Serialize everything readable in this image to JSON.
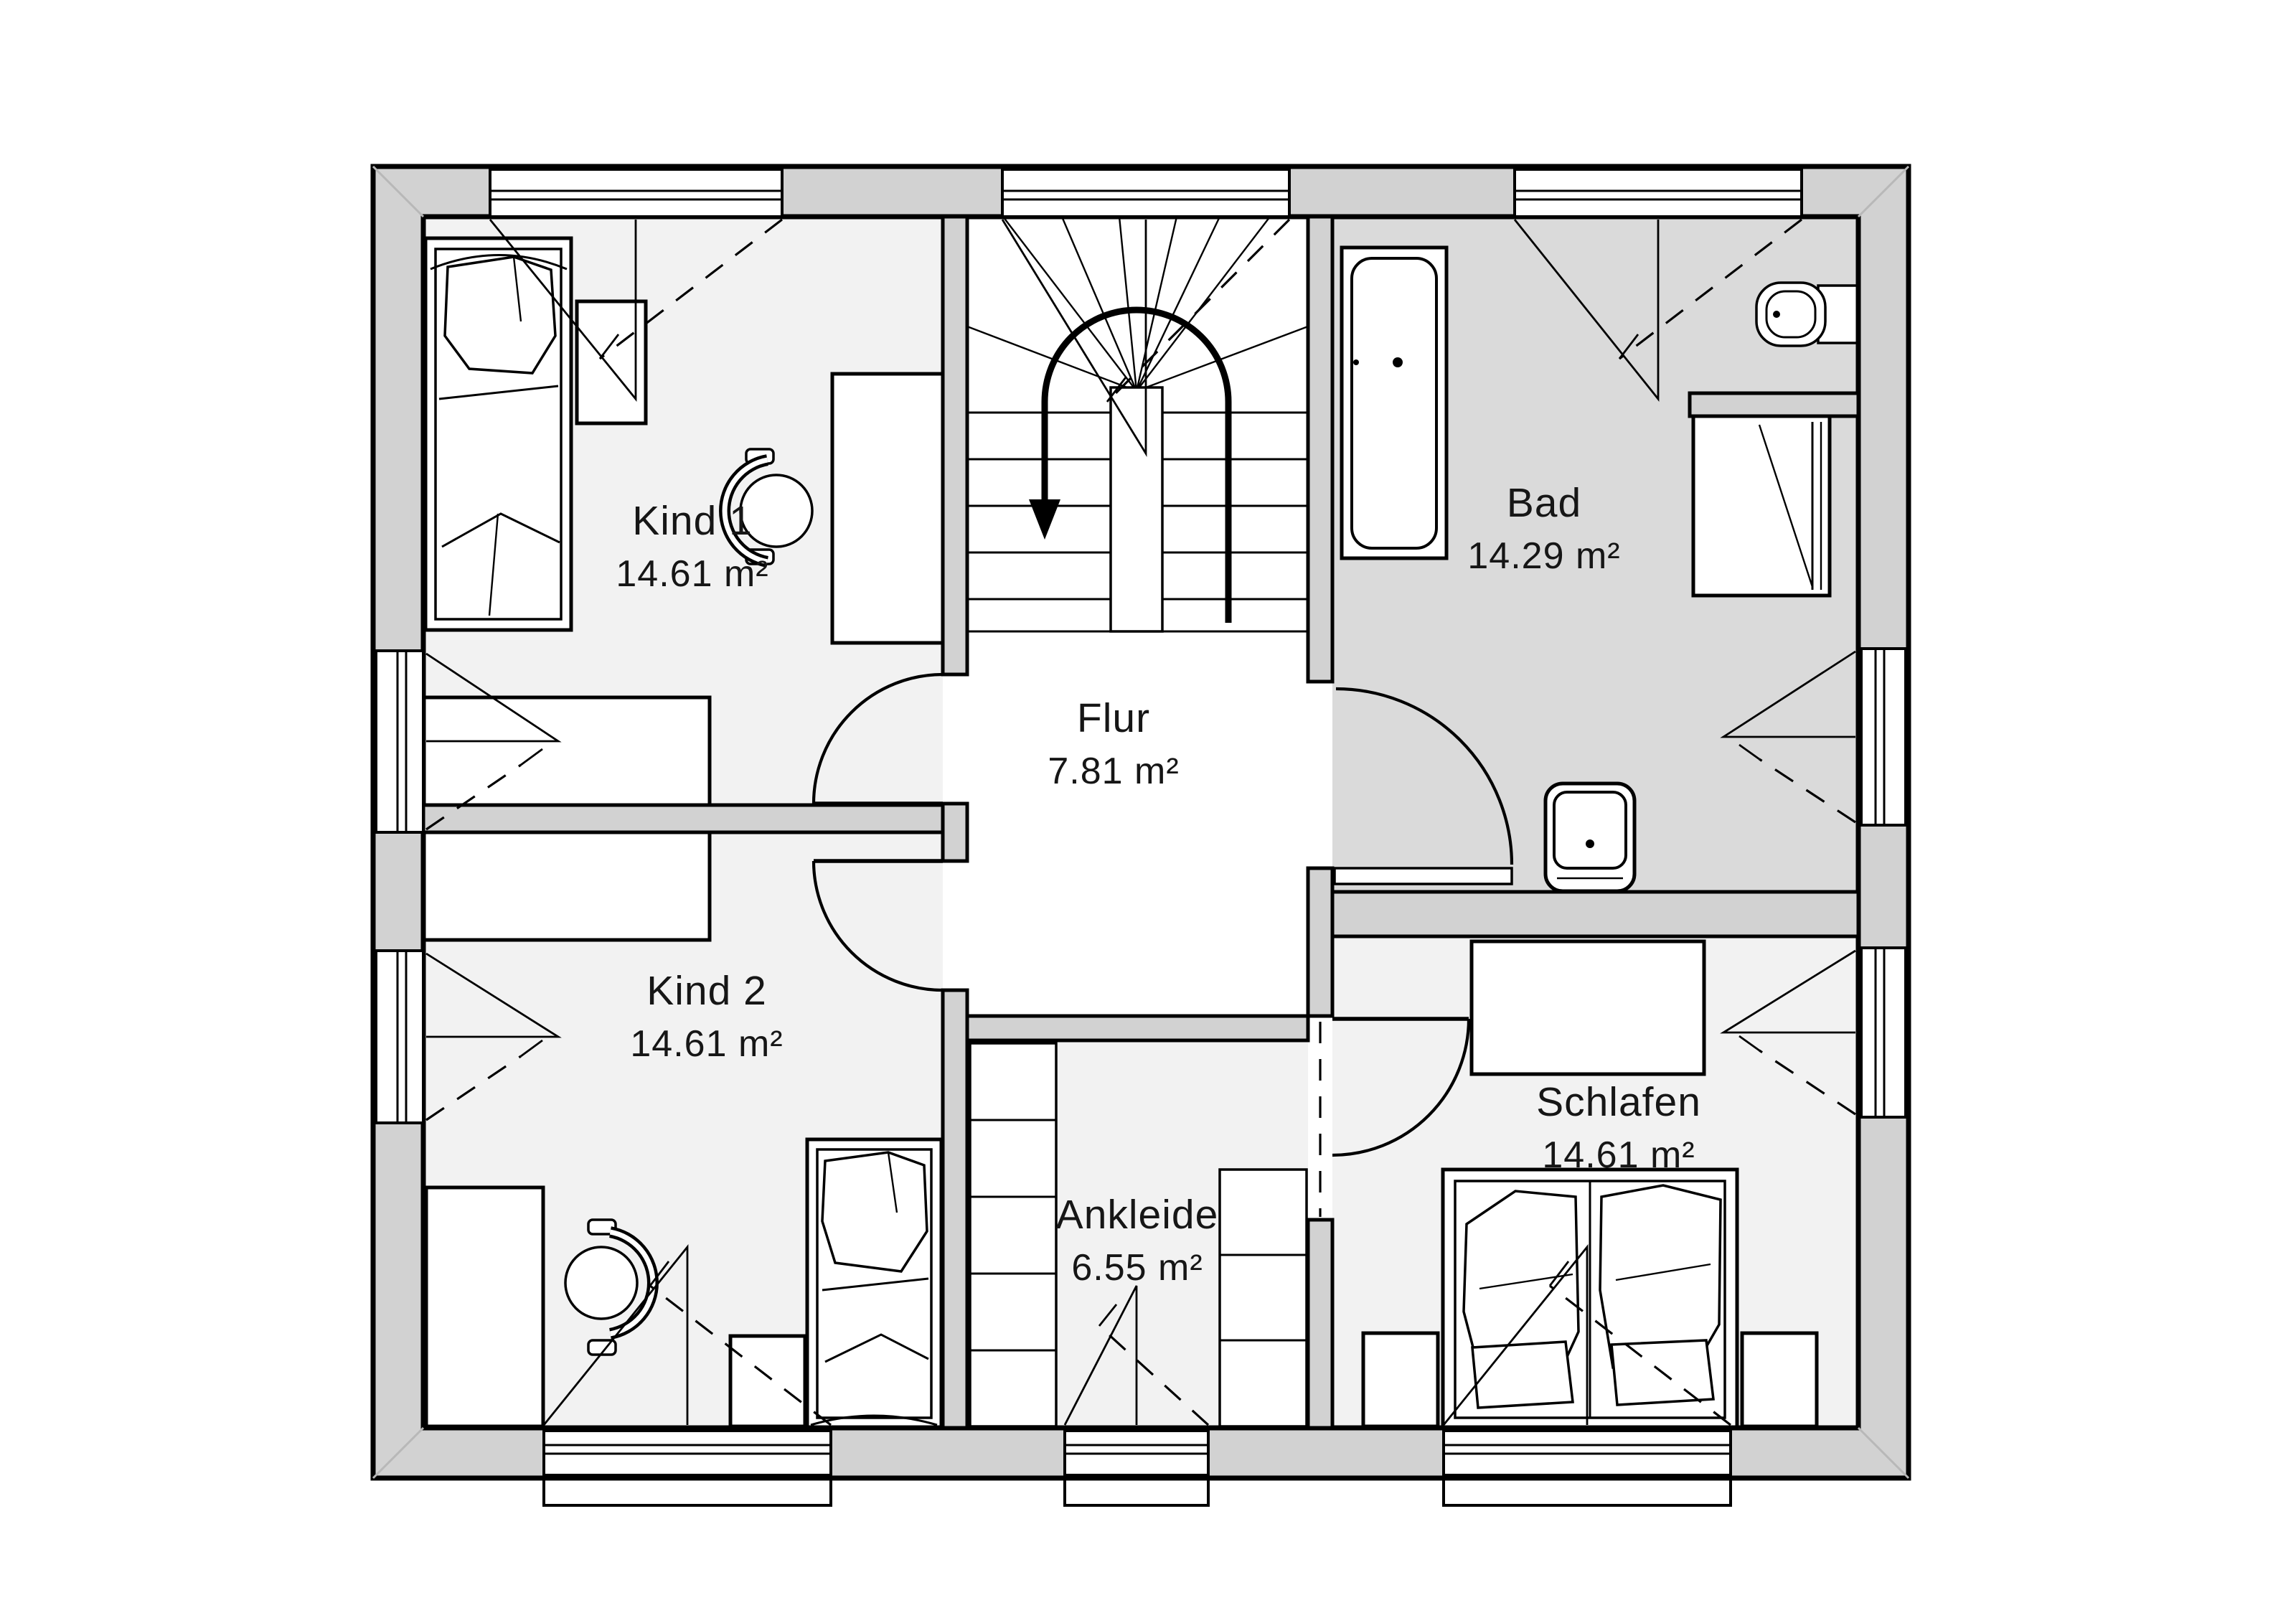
{
  "plan": {
    "rooms": [
      {
        "id": "kind1",
        "label": "Kind 1",
        "area": "14.61 m²"
      },
      {
        "id": "kind2",
        "label": "Kind 2",
        "area": "14.61 m²"
      },
      {
        "id": "flur",
        "label": "Flur",
        "area": "7.81 m²"
      },
      {
        "id": "bad",
        "label": "Bad",
        "area": "14.29 m²"
      },
      {
        "id": "ankleide",
        "label": "Ankleide",
        "area": "6.55 m²"
      },
      {
        "id": "schlafen",
        "label": "Schlafen",
        "area": "14.61 m²"
      }
    ],
    "colors": {
      "background": "#ffffff",
      "wall_fill": "#d2d2d2",
      "room_floor": "#f2f2f2",
      "bad_floor": "#dadada",
      "hall_floor": "#ffffff",
      "line": "#000000"
    }
  }
}
